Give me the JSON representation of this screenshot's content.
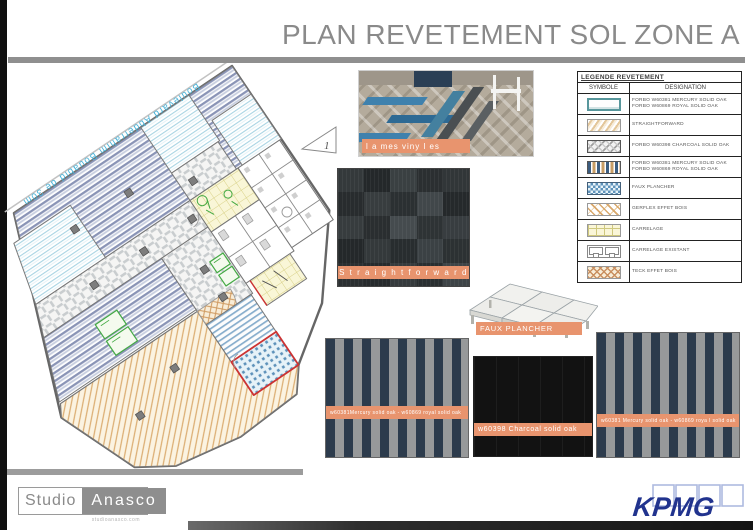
{
  "title": "PLAN REVETEMENT SOL ZONE A",
  "plan": {
    "street_label": "Boulevard  Abderrahim  Bouabid  de  30m",
    "marker": "1"
  },
  "legend": {
    "title": "LEGENDE REVETEMENT",
    "columns": {
      "symbol": "SYMBOLE",
      "designation": "DESIGNATION"
    },
    "rows": [
      {
        "symbol_name": "forbo-plain-rect",
        "lines": [
          "FORBO W60381 MERCURY SOLID OAK",
          "FORBO W60869 ROYAL SOLID OAK"
        ]
      },
      {
        "symbol_name": "straightforward-hatch",
        "lines": [
          "STRAIGHTFORWARD"
        ]
      },
      {
        "symbol_name": "charcoal-parquet",
        "lines": [
          "FORBO W60398 CHARCOAL SOLID OAK"
        ]
      },
      {
        "symbol_name": "mercury-royal-stripes",
        "lines": [
          "FORBO W60381 MERCURY SOLID OAK",
          "FORBO W60869 ROYAL SOLID OAK"
        ]
      },
      {
        "symbol_name": "faux-plancher-dots",
        "lines": [
          "FAUX PLANCHER"
        ]
      },
      {
        "symbol_name": "gerflex-effet-bois",
        "lines": [
          "GERFLEX  EFFET  BOIS"
        ]
      },
      {
        "symbol_name": "carrelage-grid",
        "lines": [
          "CARRELAGE"
        ]
      },
      {
        "symbol_name": "carrelage-existant",
        "lines": [
          "CARRELAGE  EXISTANT"
        ]
      },
      {
        "symbol_name": "teck-effet-bois",
        "lines": [
          "TECK EFFET BOIS"
        ]
      }
    ]
  },
  "swatches": {
    "vinyl": {
      "label": "l a mes viny l es"
    },
    "straightforward": {
      "label": "S t r a i g h t f o r w a r d"
    },
    "faux_plancher": {
      "label": "FAUX PLANCHER"
    },
    "stripes_left": {
      "label": "w60381Mercury solid oak  -  w60869 royal solid oak"
    },
    "charcoal": {
      "label": "w60398 Charcoal solid oak"
    },
    "stripes_right": {
      "label": "w60381 Mercury solid oak  -  w60869 roya l solid oak"
    }
  },
  "footer": {
    "studio": {
      "part1": "Studio",
      "part2": "Anasco",
      "url": "studioanasco.com"
    },
    "kpmg": "KPMG"
  },
  "colors": {
    "banner_orange": "#E8946E",
    "kpmg_blue": "#21338E",
    "title_gray": "#8A8A8A",
    "street_blue": "#48B4DA"
  }
}
